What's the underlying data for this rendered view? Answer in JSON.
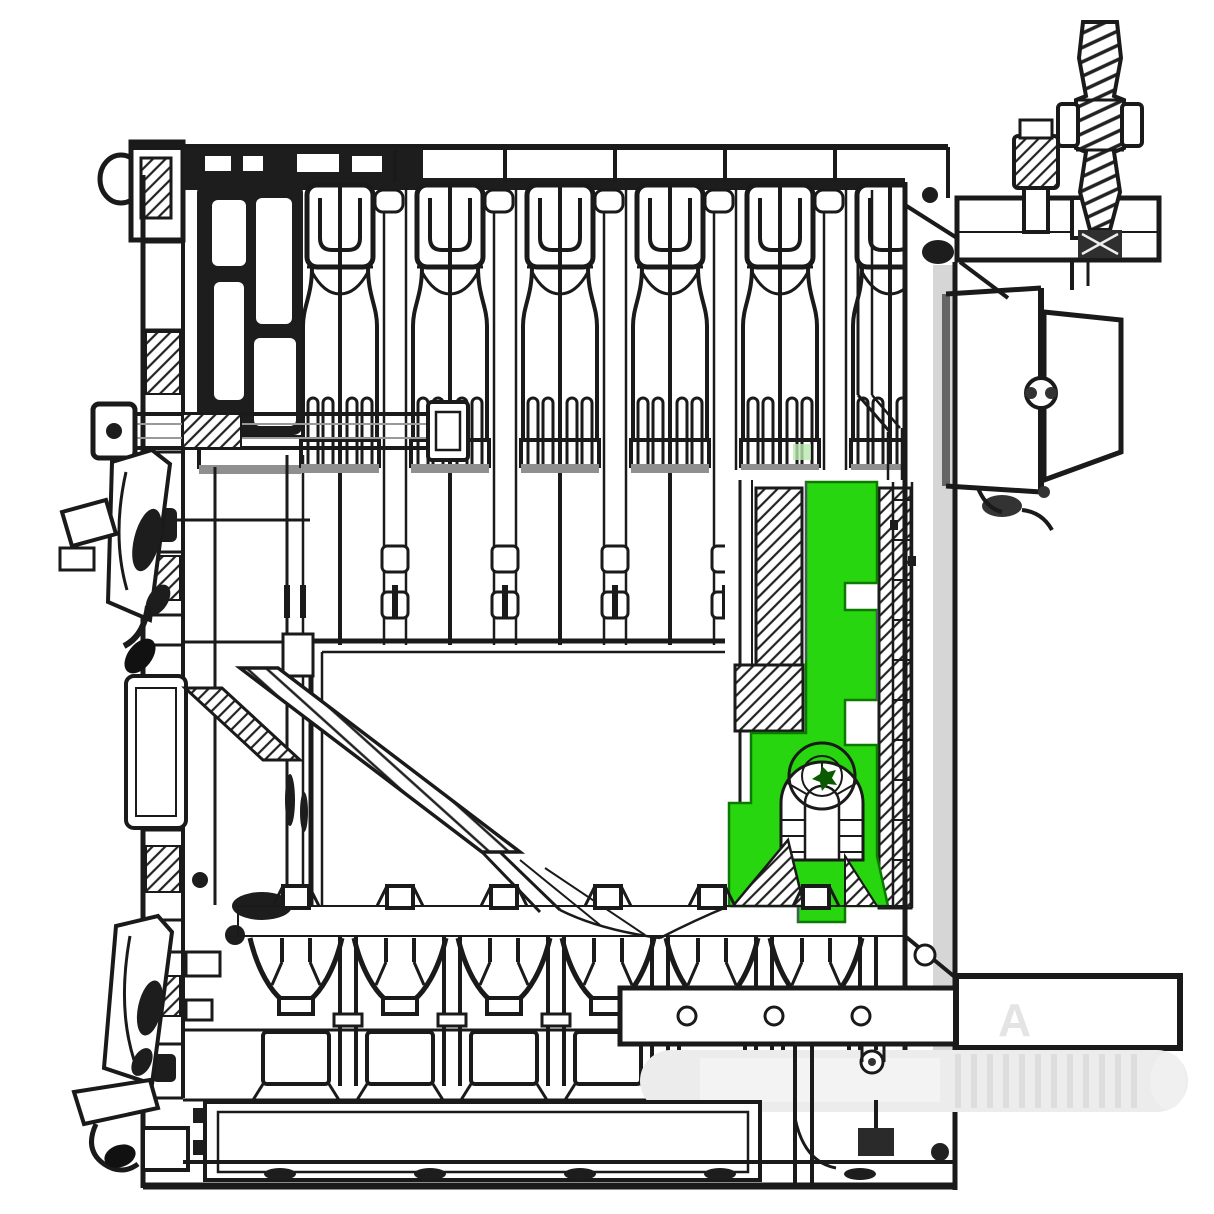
{
  "diagram": {
    "type": "technical-cross-section",
    "description": "Side cross-section drawing of a sectional cast-iron boiler with one internal bracket component highlighted in green",
    "highlight": {
      "part_name": "highlighted-bracket",
      "fill": "#27d60e",
      "boss_fill": "#1fbf0a",
      "edge": "#0c7a00"
    },
    "colors": {
      "background": "#ffffff",
      "line": "#1a1a1a",
      "mid_gray": "#cfcfcf",
      "dark_band": "#4a4a4a",
      "wall_gray": "#d6d6d6",
      "ghost": "#ececec",
      "ghost_stripe": "#dddddd",
      "accent_purple": "#8b2fc9",
      "light_green_blip": "#b9e7ae",
      "watermark": "#e4e4e4"
    },
    "watermark_letter": "A",
    "repeats": {
      "top_sections": {
        "count": 6,
        "spacing_px": 110
      },
      "bottom_sections": {
        "count": 6,
        "spacing_px": 104
      },
      "tie_bar_holes": {
        "count": 3,
        "spacing_px": 87
      }
    },
    "components": [
      "outer-casing",
      "top-header-rail",
      "heat-exchanger-fins",
      "combustion-chamber",
      "diagonal-baffle",
      "highlighted-bracket",
      "anchor-bolt-boss",
      "right-flue-outlet",
      "threaded-tension-rod",
      "flange-plate",
      "left-hinge-upper",
      "left-hinge-lower",
      "tie-rod",
      "lower-section-row",
      "tie-bar-with-holes",
      "side-extension-bar",
      "ghost-cylinder",
      "ash-door"
    ]
  }
}
